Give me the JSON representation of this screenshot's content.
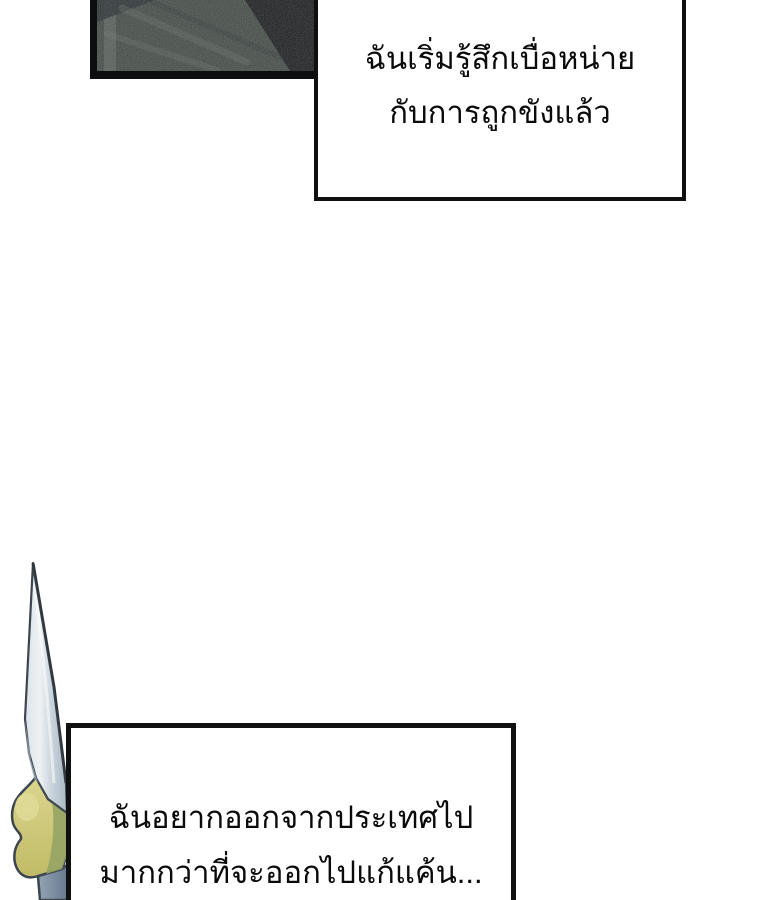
{
  "page": {
    "kind": "webtoon-comic-page",
    "background": "#ffffff",
    "width": 760,
    "height": 900
  },
  "panel": {
    "description": "dark blurry interior scene fragment, cropped at top of page",
    "border_color": "#0d0e0f",
    "base_color": "#414a45",
    "light_strip_color": "#5b645d",
    "dark_corner_color": "#16181b",
    "streak_dark": "#272e30",
    "streak_light": "#6b746d"
  },
  "bubbles": {
    "top": {
      "lines": {
        "0": "ฉันเริ่มรู้สึกเบื่อหน่าย",
        "1": "กับการถูกขังแล้ว"
      },
      "fill": "#ffffff",
      "border_color": "#101010",
      "text_color": "#0a0a0a"
    },
    "bottom": {
      "lines": {
        "0": "ฉันอยากออกจากประเทศไป",
        "1": "มากกว่าที่จะออกไปแก้แค้น..."
      },
      "fill": "#ffffff",
      "border_color": "#101010",
      "text_color": "#0a0a0a"
    }
  },
  "sword": {
    "description": "upright dagger blade with yellow-green grip wrap and blue-gray handle, cropped at page bottom",
    "blade_light": "#f0f5f8",
    "blade_mid": "#cfd9e2",
    "blade_shadow": "#a9b9c6",
    "edge_dark": "#2d353d",
    "outline": "#39424c",
    "grip_yellow_light": "#e4de97",
    "grip_yellow": "#cfc96f",
    "grip_olive": "#93a35f",
    "handle_light": "#91a3b5",
    "handle_dark": "#5f7389"
  }
}
